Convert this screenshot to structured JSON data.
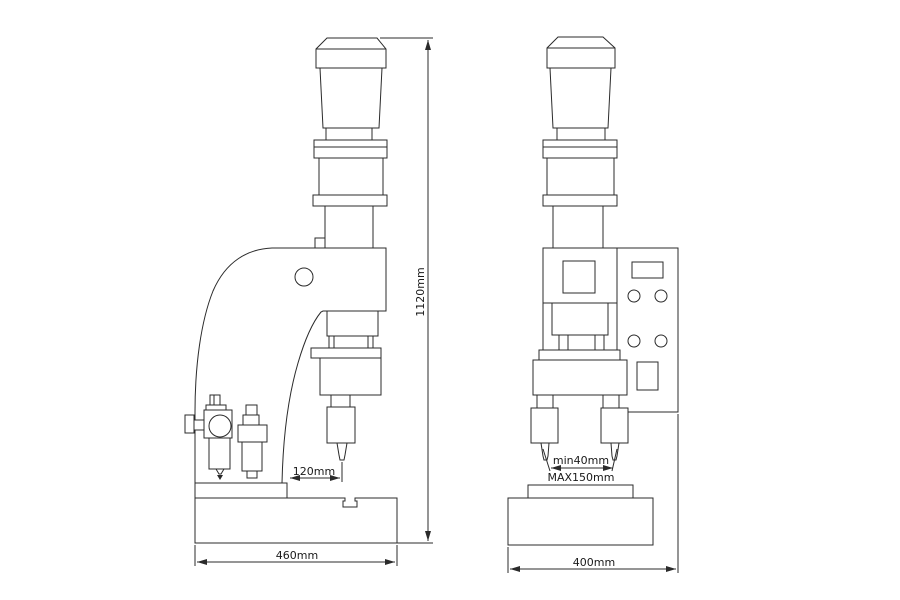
{
  "diagram": {
    "background_color": "#ffffff",
    "line_color": "#2b2b2b",
    "views": {
      "side": {
        "dimensions": {
          "tool_offset": "120mm",
          "base_width": "460mm",
          "overall_height": "1120mm"
        }
      },
      "front": {
        "dimensions": {
          "tool_gap_min": "min40mm",
          "tool_gap_max": "MAX150mm",
          "base_width": "400mm"
        }
      }
    }
  }
}
